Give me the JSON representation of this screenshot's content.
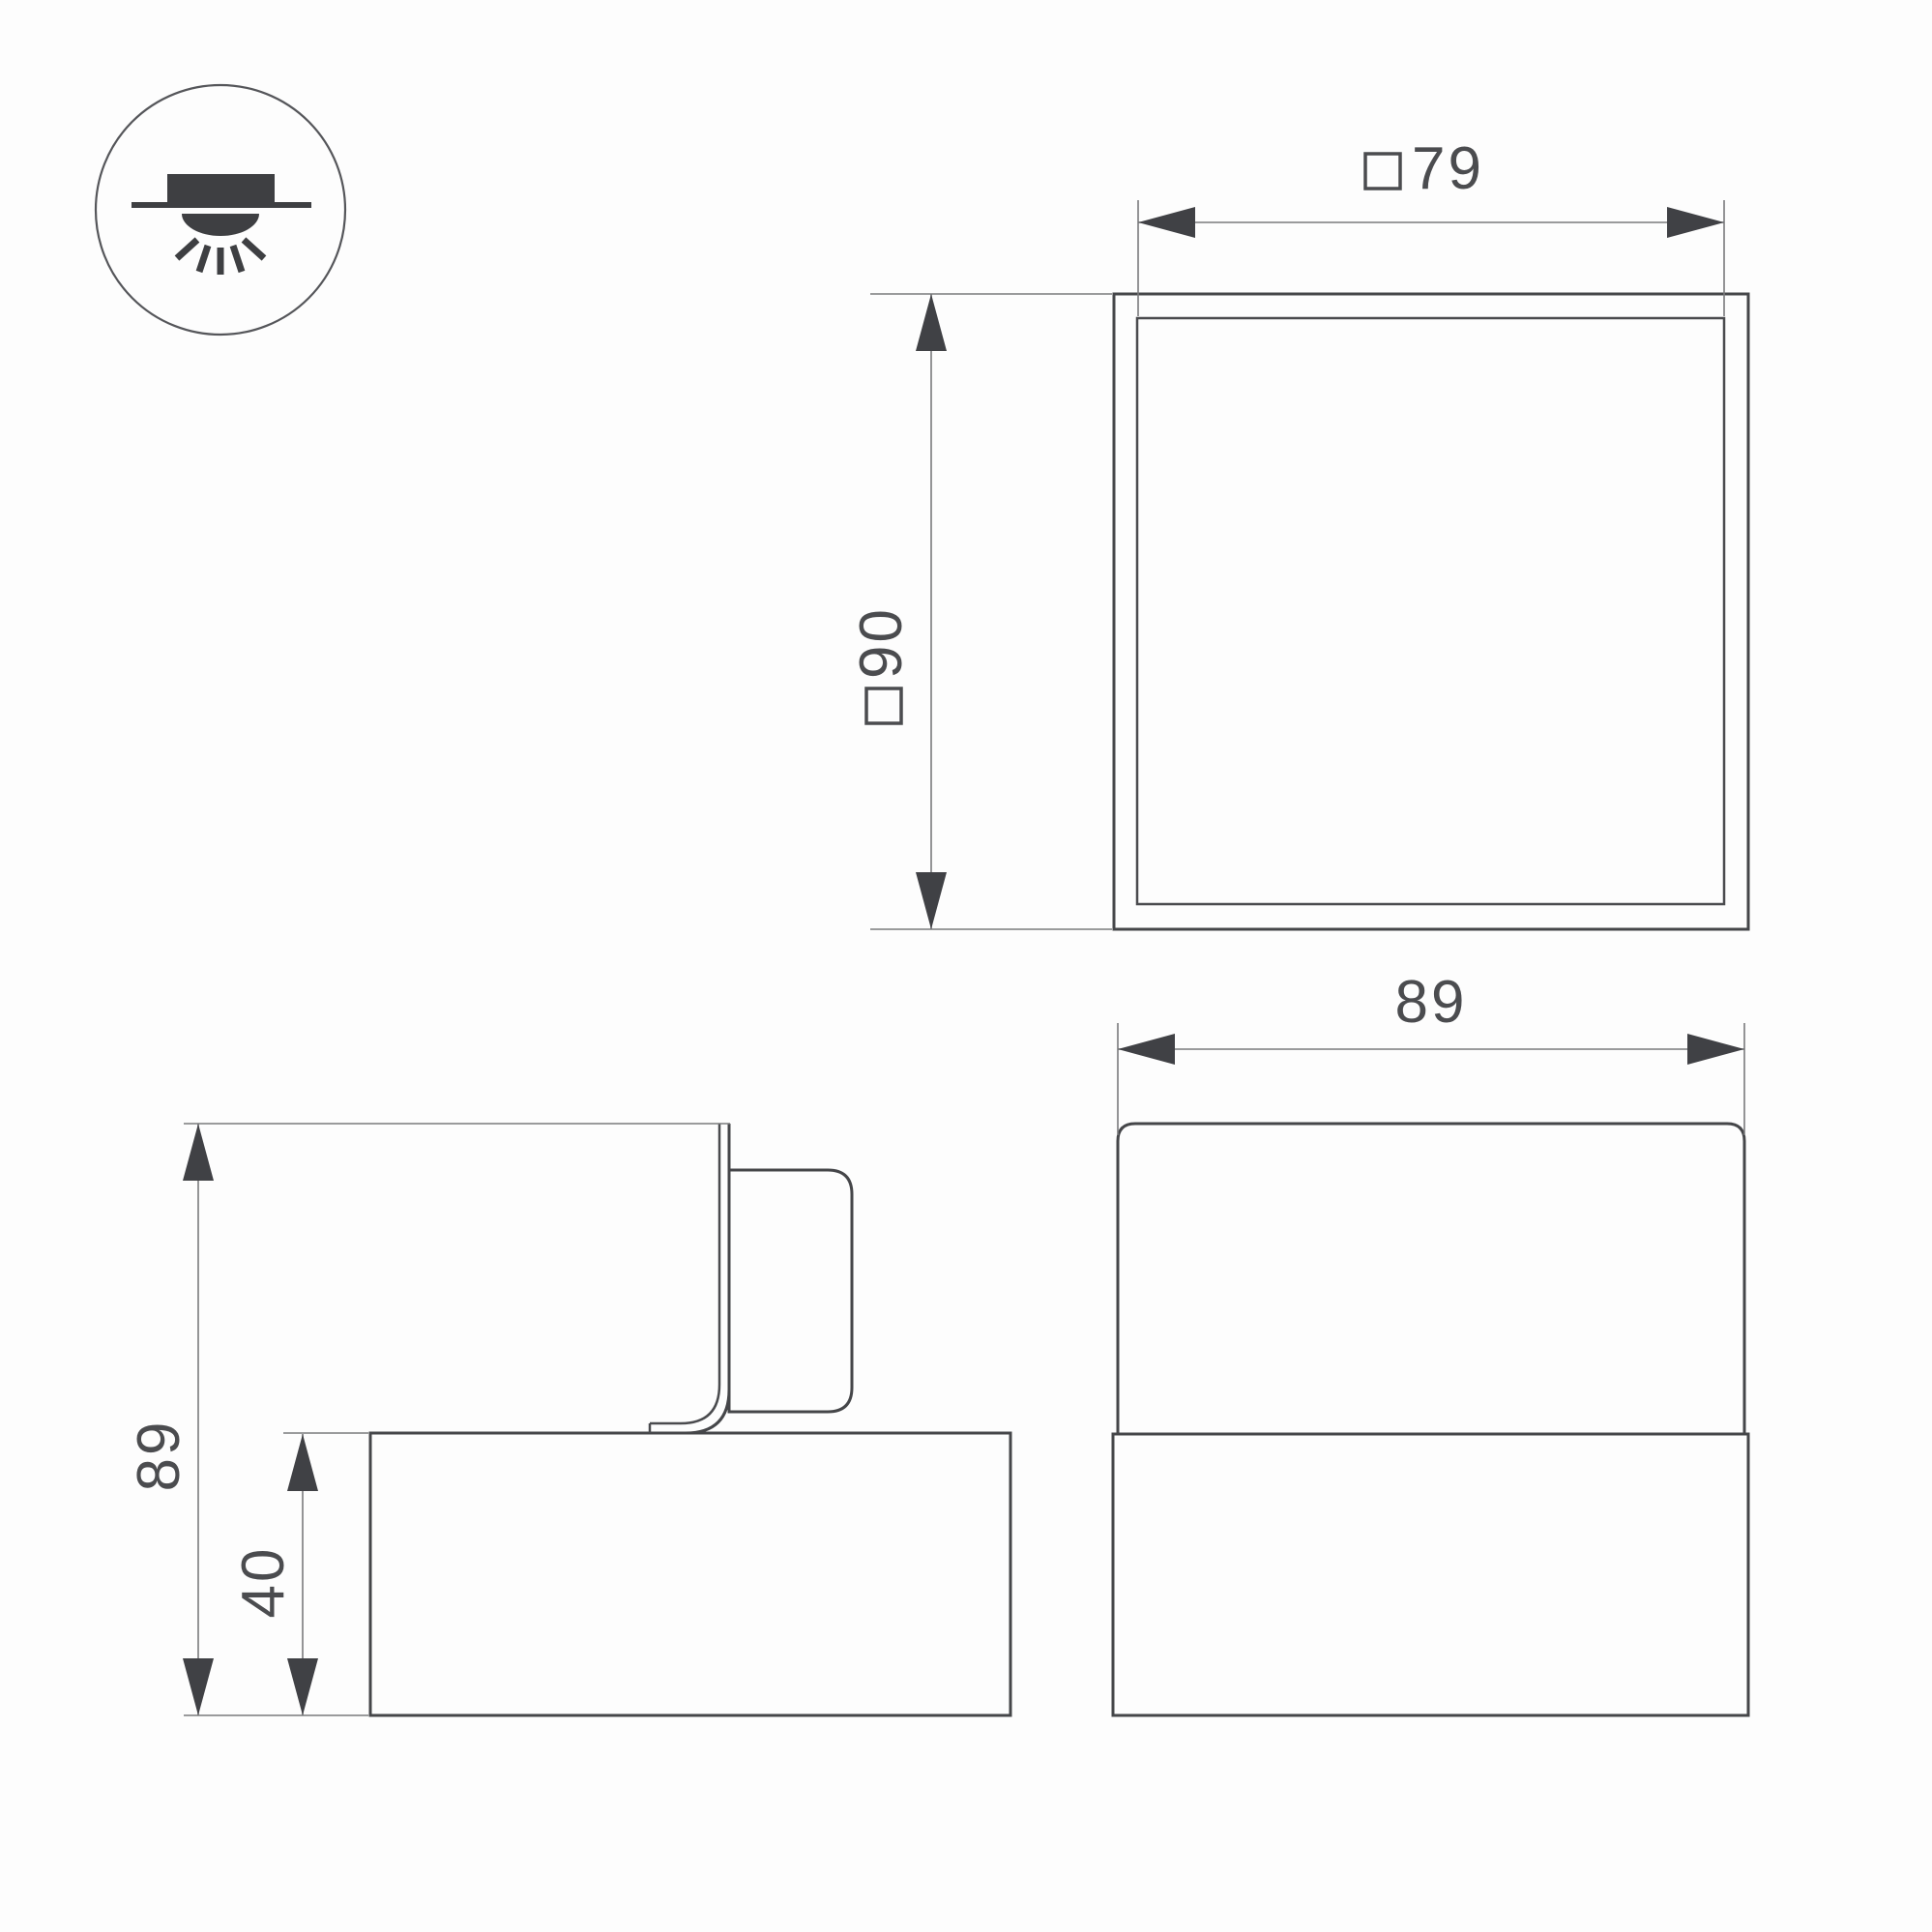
{
  "drawing": {
    "icon": {
      "type": "surface-mounted-downlight"
    },
    "labels": {
      "top_width": {
        "prefix": "□",
        "value": "79"
      },
      "top_height": {
        "prefix": "□",
        "value": "90"
      },
      "front_width": {
        "value": "89"
      },
      "side_height": {
        "value": "89"
      },
      "side_base_height": {
        "value": "40"
      }
    },
    "colors": {
      "line": "#454649",
      "thin_line": "#7a7b7d",
      "arrow": "#404145",
      "text": "#4b4c4f",
      "background": "#fdfdfd"
    }
  }
}
